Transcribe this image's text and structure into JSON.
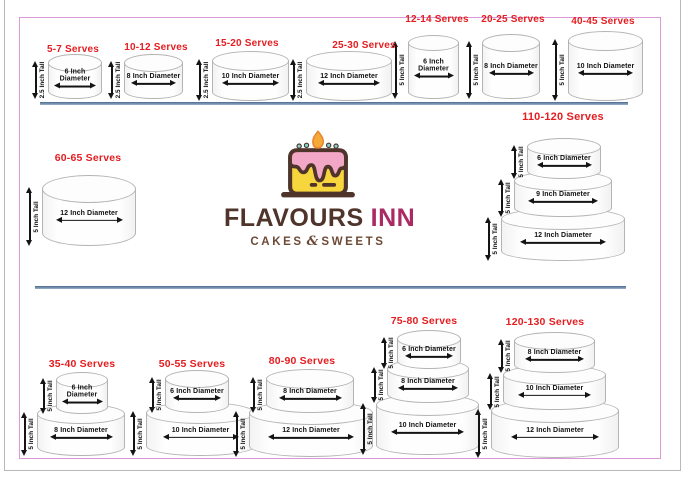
{
  "colors": {
    "title_red": "#e51d20",
    "border_pink": "#db9ad7",
    "divider_blue": "#4a698d",
    "brand_brown": "#4f342b",
    "brand_magenta": "#ab2a64",
    "tagline_brown": "#6d4a36",
    "cake_outline_gray": "#b4b4b4",
    "logo_yellow": "#f7d53c",
    "logo_pink": "#f2a7c6",
    "logo_flame_orange": "#f6a93b"
  },
  "brand": {
    "name_primary": "FLAVOURS",
    "name_secondary": "INN",
    "tagline_left": "CAKES",
    "tagline_amp": "&",
    "tagline_right": "SWEETS",
    "logo_icon": "cake-with-flame-icon"
  },
  "cakes": [
    {
      "id": "5-7",
      "title": "5-7 Serves",
      "tiers": [
        {
          "diameter": "6 Inch Diameter",
          "height": "2.5 Inch Tall"
        }
      ]
    },
    {
      "id": "10-12",
      "title": "10-12 Serves",
      "tiers": [
        {
          "diameter": "8 Inch Diameter",
          "height": "2.5 Inch Tall"
        }
      ]
    },
    {
      "id": "15-20",
      "title": "15-20 Serves",
      "tiers": [
        {
          "diameter": "10 Inch Diameter",
          "height": "2.5 Inch Tall"
        }
      ]
    },
    {
      "id": "25-30",
      "title": "25-30 Serves",
      "tiers": [
        {
          "diameter": "12 Inch Diameter",
          "height": "2.5 Inch Tall"
        }
      ]
    },
    {
      "id": "12-14",
      "title": "12-14 Serves",
      "tiers": [
        {
          "diameter": "6 Inch Diameter",
          "height": "5 Inch Tall"
        }
      ]
    },
    {
      "id": "20-25",
      "title": "20-25 Serves",
      "tiers": [
        {
          "diameter": "8 Inch Diameter",
          "height": "5 Inch Tall"
        }
      ]
    },
    {
      "id": "40-45",
      "title": "40-45 Serves",
      "tiers": [
        {
          "diameter": "10 Inch Diameter",
          "height": "5 Inch Tall"
        }
      ]
    },
    {
      "id": "60-65",
      "title": "60-65 Serves",
      "tiers": [
        {
          "diameter": "12 Inch Diameter",
          "height": "5 Inch Tall"
        }
      ]
    },
    {
      "id": "110-120",
      "title": "110-120 Serves",
      "tiers": [
        {
          "diameter": "6 Inch Diameter",
          "height": "5 Inch Tall"
        },
        {
          "diameter": "9 Inch Diameter",
          "height": "5 Inch Tall"
        },
        {
          "diameter": "12 Inch Diameter",
          "height": "5 Inch Tall"
        }
      ]
    },
    {
      "id": "35-40",
      "title": "35-40 Serves",
      "tiers": [
        {
          "diameter": "6 Inch Diameter",
          "height": "5 Inch Tall"
        },
        {
          "diameter": "8 Inch Diameter",
          "height": "5 Inch Tall"
        }
      ]
    },
    {
      "id": "50-55",
      "title": "50-55 Serves",
      "tiers": [
        {
          "diameter": "6 Inch Diameter",
          "height": "5 Inch Tall"
        },
        {
          "diameter": "10 Inch Diameter",
          "height": "5 Inch Tall"
        }
      ]
    },
    {
      "id": "80-90",
      "title": "80-90 Serves",
      "tiers": [
        {
          "diameter": "8 Inch Diameter",
          "height": "5 Inch Tall"
        },
        {
          "diameter": "12 Inch Diameter",
          "height": "5 Inch Tall"
        }
      ]
    },
    {
      "id": "75-80",
      "title": "75-80 Serves",
      "tiers": [
        {
          "diameter": "6 Inch Diameter",
          "height": "5 Inch Tall"
        },
        {
          "diameter": "8 Inch Diameter",
          "height": "5 Inch Tall"
        },
        {
          "diameter": "10 Inch Diameter",
          "height": "5 Inch Tall"
        }
      ]
    },
    {
      "id": "120-130",
      "title": "120-130 Serves",
      "tiers": [
        {
          "diameter": "8 Inch Diameter",
          "height": "5 Inch Tall"
        },
        {
          "diameter": "10 Inch Diameter",
          "height": "5 Inch Tall"
        },
        {
          "diameter": "12 Inch Diameter",
          "height": "5 Inch Tall"
        }
      ]
    }
  ]
}
